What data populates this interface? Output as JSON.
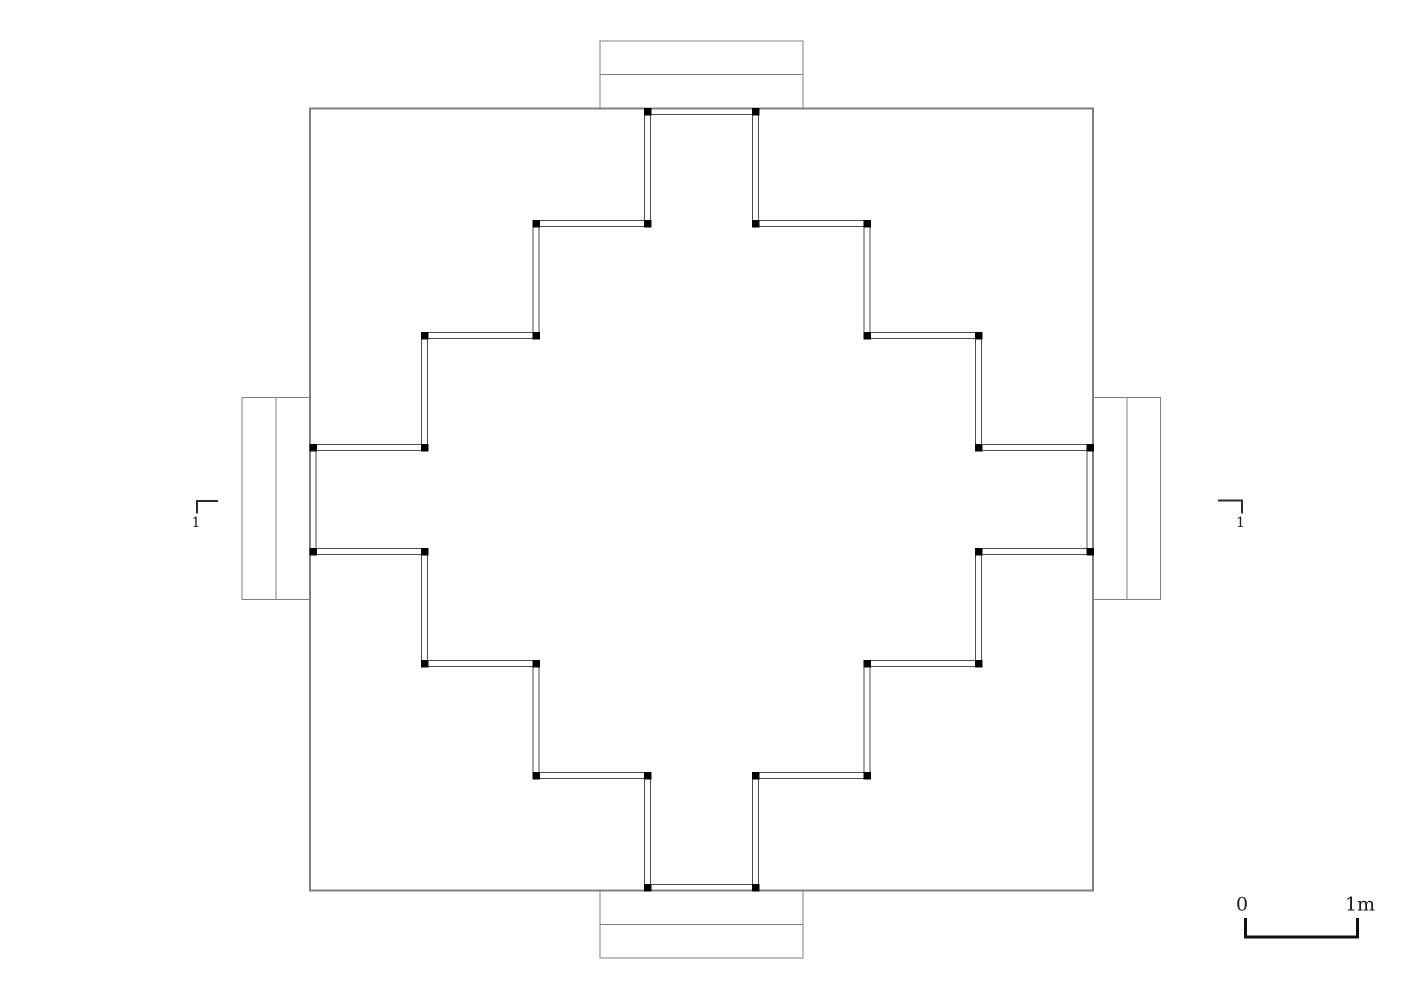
{
  "figure": {
    "type": "architectural-floor-plan",
    "description": "Plan of a square platform with a stepped-diamond chamber, four axial porches with steps, corner column markers, section cut markers and a metric scale bar"
  },
  "labels": {
    "section_marker_left": "1",
    "section_marker_right": "1",
    "scale_zero": "0",
    "scale_one": "1m"
  },
  "colors": {
    "background": "#ffffff",
    "platform_outline": "#808080",
    "wall_line": "#4d4d4d",
    "column": "#000000",
    "marker": "#2b2b2b",
    "scalebar": "#111111"
  },
  "geometry": {
    "canvas": {
      "width": 1413,
      "height": 1000
    },
    "platform": {
      "x": 310,
      "y": 108.5,
      "width": 783,
      "height": 782
    },
    "porches": [
      {
        "name": "porch-top",
        "rect": {
          "x": 600,
          "y": 41,
          "width": 203,
          "height": 67.5
        },
        "divider": {
          "x1": 600,
          "y1": 74.5,
          "x2": 803,
          "y2": 74.5
        }
      },
      {
        "name": "porch-bottom",
        "rect": {
          "x": 600,
          "y": 890.5,
          "width": 203,
          "height": 67.5
        },
        "divider": {
          "x1": 600,
          "y1": 924.5,
          "x2": 803,
          "y2": 924.5
        }
      },
      {
        "name": "porch-left",
        "rect": {
          "x": 242,
          "y": 397.5,
          "width": 68,
          "height": 202
        },
        "divider": {
          "x1": 276,
          "y1": 397.5,
          "x2": 276,
          "y2": 599.5
        }
      },
      {
        "name": "porch-right",
        "rect": {
          "x": 1093,
          "y": 397.5,
          "width": 67.5,
          "height": 202
        },
        "divider": {
          "x1": 1126.8,
          "y1": 397.5,
          "x2": 1126.8,
          "y2": 599.5
        }
      }
    ],
    "chamber_wall": {
      "inner_outline": [
        [
          650.5,
          114.5
        ],
        [
          650.5,
          226.5
        ],
        [
          539,
          226.5
        ],
        [
          539,
          338.5
        ],
        [
          427.5,
          338.5
        ],
        [
          427.5,
          450.5
        ],
        [
          316,
          450.5
        ],
        [
          316,
          548.5
        ],
        [
          427.5,
          548.5
        ],
        [
          427.5,
          660.5
        ],
        [
          539,
          660.5
        ],
        [
          539,
          772.5
        ],
        [
          650.5,
          772.5
        ],
        [
          650.5,
          884.5
        ],
        [
          752.5,
          884.5
        ],
        [
          752.5,
          772.5
        ],
        [
          864,
          772.5
        ],
        [
          864,
          660.5
        ],
        [
          975.5,
          660.5
        ],
        [
          975.5,
          548.5
        ],
        [
          1087,
          548.5
        ],
        [
          1087,
          450.5
        ],
        [
          975.5,
          450.5
        ],
        [
          975.5,
          338.5
        ],
        [
          864,
          338.5
        ],
        [
          864,
          226.5
        ],
        [
          752.5,
          226.5
        ],
        [
          752.5,
          114.5
        ]
      ],
      "outer_polylines": [
        [
          [
            644.5,
            108.5
          ],
          [
            644.5,
            220.5
          ],
          [
            533,
            220.5
          ],
          [
            533,
            332.5
          ],
          [
            421.5,
            332.5
          ],
          [
            421.5,
            444.5
          ],
          [
            310,
            444.5
          ]
        ],
        [
          [
            310,
            554.5
          ],
          [
            421.5,
            554.5
          ],
          [
            421.5,
            666.5
          ],
          [
            533,
            666.5
          ],
          [
            533,
            778.5
          ],
          [
            644.5,
            778.5
          ],
          [
            644.5,
            890.5
          ]
        ],
        [
          [
            758.5,
            890.5
          ],
          [
            758.5,
            778.5
          ],
          [
            870,
            778.5
          ],
          [
            870,
            666.5
          ],
          [
            981.5,
            666.5
          ],
          [
            981.5,
            554.5
          ],
          [
            1093,
            554.5
          ]
        ],
        [
          [
            1093,
            444.5
          ],
          [
            981.5,
            444.5
          ],
          [
            981.5,
            332.5
          ],
          [
            870,
            332.5
          ],
          [
            870,
            220.5
          ],
          [
            758.5,
            220.5
          ],
          [
            758.5,
            108.5
          ]
        ]
      ],
      "columns": {
        "size": 7.5,
        "centers": [
          [
            647.5,
            111.5
          ],
          [
            647.5,
            223.5
          ],
          [
            536,
            223.5
          ],
          [
            536,
            335.5
          ],
          [
            424.5,
            335.5
          ],
          [
            424.5,
            447.5
          ],
          [
            313,
            447.5
          ],
          [
            313,
            551.5
          ],
          [
            424.5,
            551.5
          ],
          [
            424.5,
            663.5
          ],
          [
            536,
            663.5
          ],
          [
            536,
            775.5
          ],
          [
            647.5,
            775.5
          ],
          [
            647.5,
            887.5
          ],
          [
            755.5,
            887.5
          ],
          [
            755.5,
            775.5
          ],
          [
            867,
            775.5
          ],
          [
            867,
            663.5
          ],
          [
            978.5,
            663.5
          ],
          [
            978.5,
            551.5
          ],
          [
            1090,
            551.5
          ],
          [
            1090,
            447.5
          ],
          [
            978.5,
            447.5
          ],
          [
            978.5,
            335.5
          ],
          [
            867,
            335.5
          ],
          [
            867,
            223.5
          ],
          [
            755.5,
            223.5
          ],
          [
            755.5,
            111.5
          ]
        ]
      }
    },
    "section_markers": [
      {
        "name": "section-marker-left",
        "polyline": [
          [
            218,
            501
          ],
          [
            197,
            501
          ],
          [
            197,
            513.5
          ]
        ],
        "label_x": 196,
        "label_y": 523
      },
      {
        "name": "section-marker-right",
        "polyline": [
          [
            1218,
            500.5
          ],
          [
            1242,
            500.5
          ],
          [
            1242,
            513.5
          ]
        ],
        "label_x": 1240.5,
        "label_y": 523
      }
    ],
    "scale_bar": {
      "polyline": [
        [
          1245.5,
          918
        ],
        [
          1245.5,
          937
        ],
        [
          1357.5,
          937
        ],
        [
          1357.5,
          918
        ]
      ],
      "zero_x": 1242,
      "zero_y": 905,
      "one_x": 1360,
      "one_y": 905
    }
  }
}
